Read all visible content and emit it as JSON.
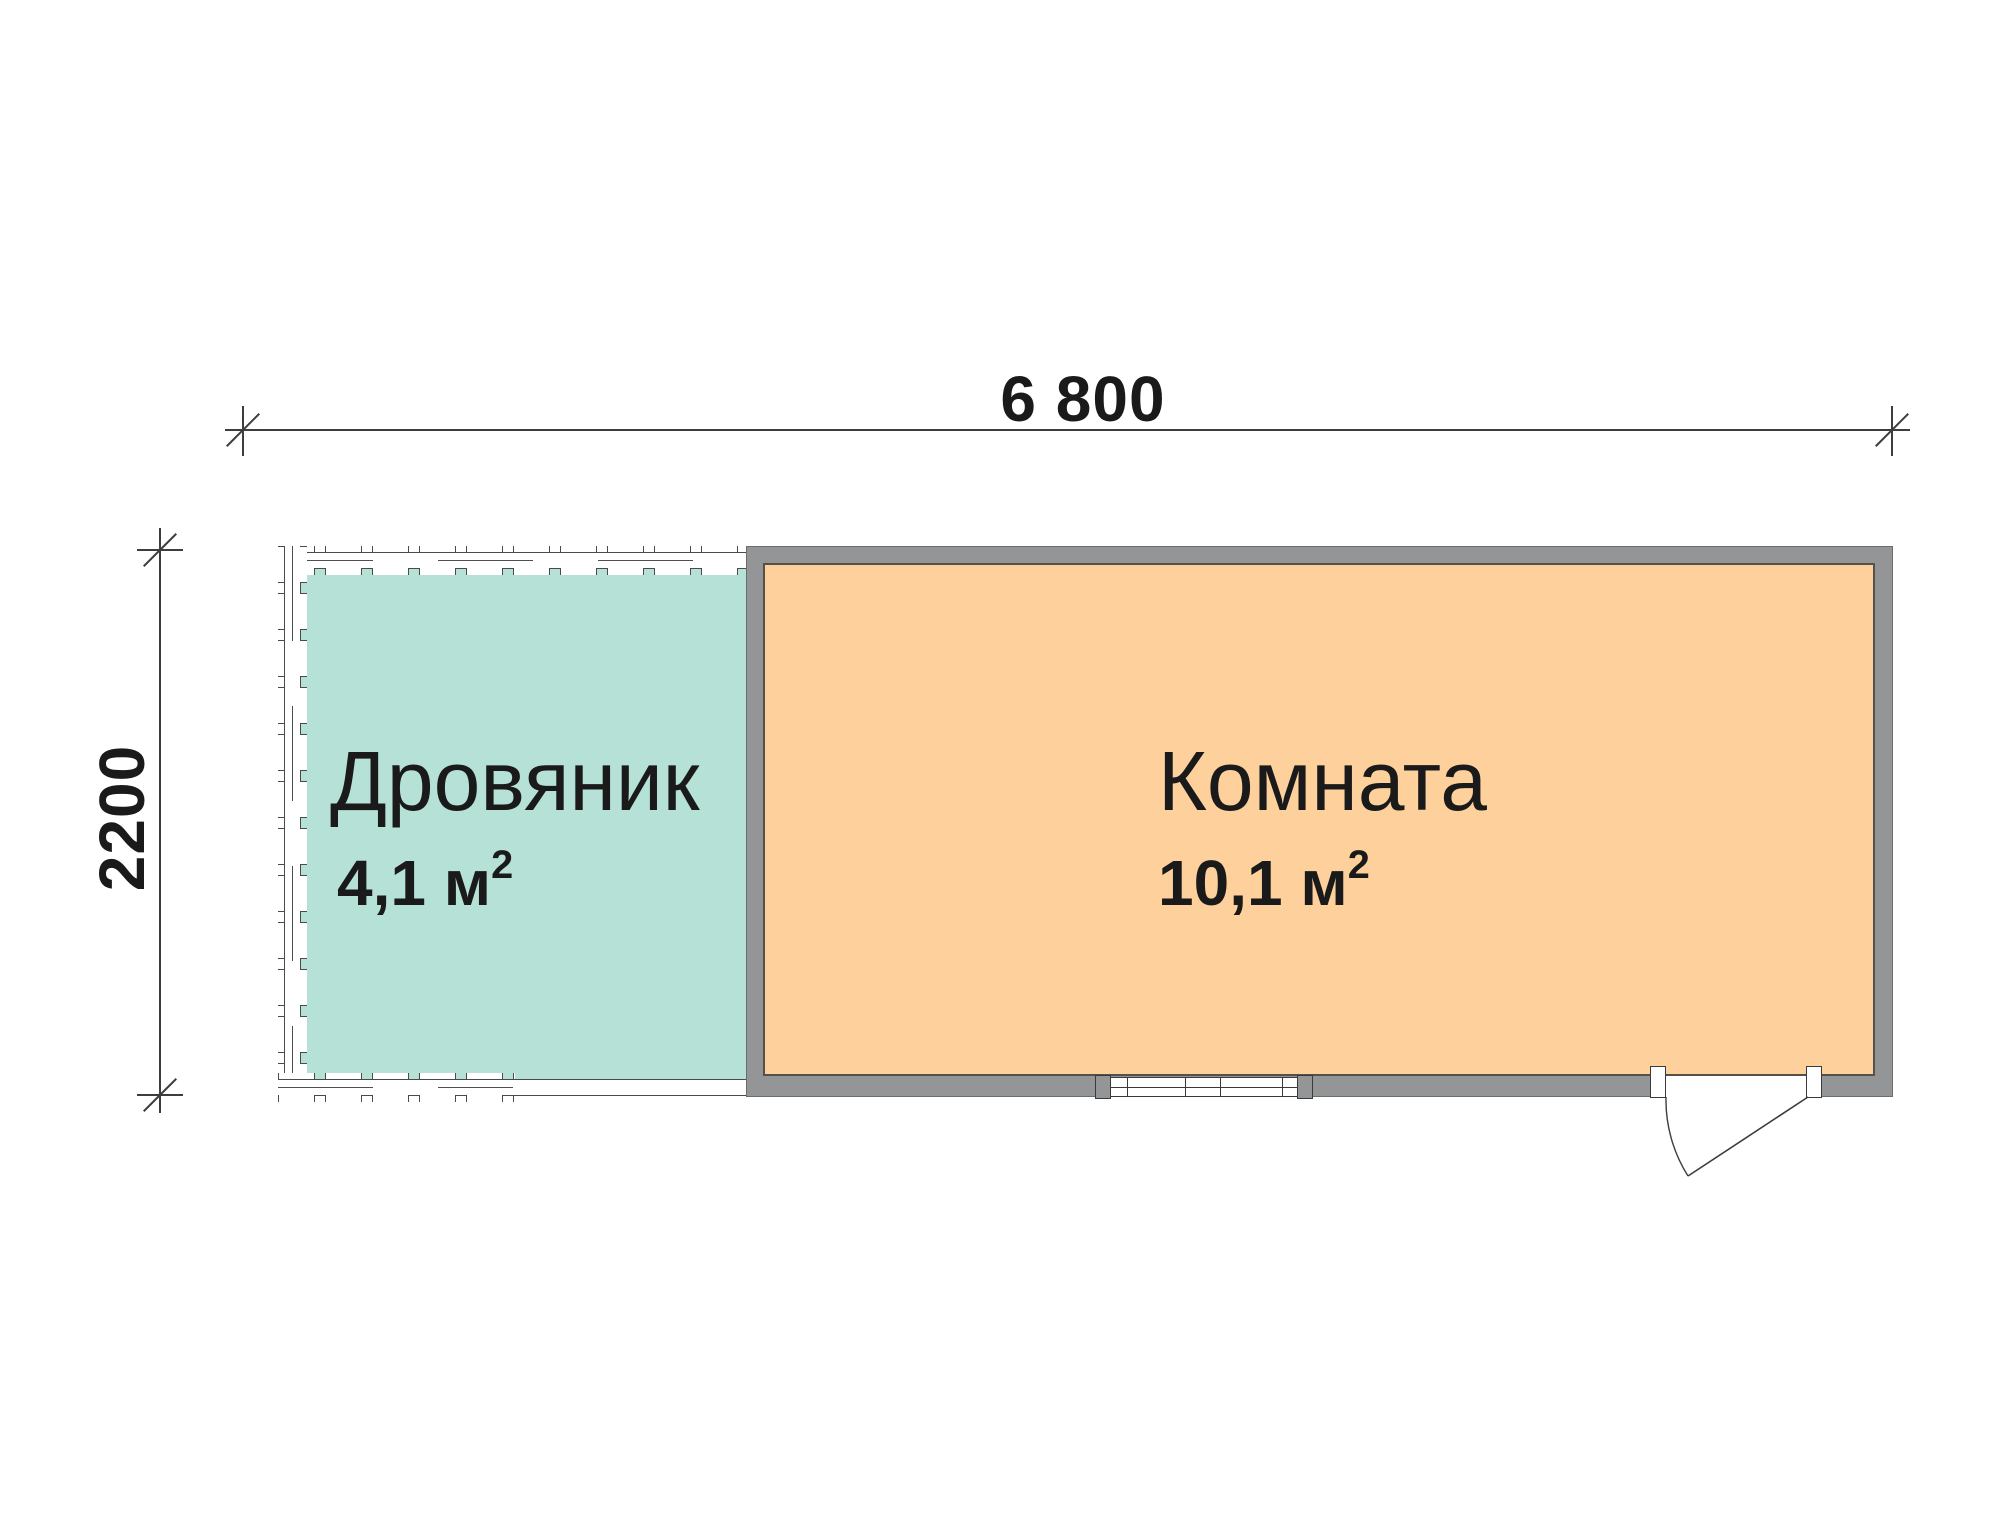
{
  "plan": {
    "dimensions": {
      "width_label": "6 800",
      "height_label": "2200"
    },
    "rooms": [
      {
        "name": "Дровяник",
        "area_value": "4,1 м",
        "area_sup": "2"
      },
      {
        "name": "Комната",
        "area_value": "10,1 м",
        "area_sup": "2"
      }
    ],
    "symbols": [
      "window",
      "door-swing"
    ],
    "colors": {
      "woodshed_fill": "#b6e1d6",
      "room_fill": "#fed09c",
      "wall_gray": "#939597",
      "line": "#3d3d3d"
    }
  }
}
